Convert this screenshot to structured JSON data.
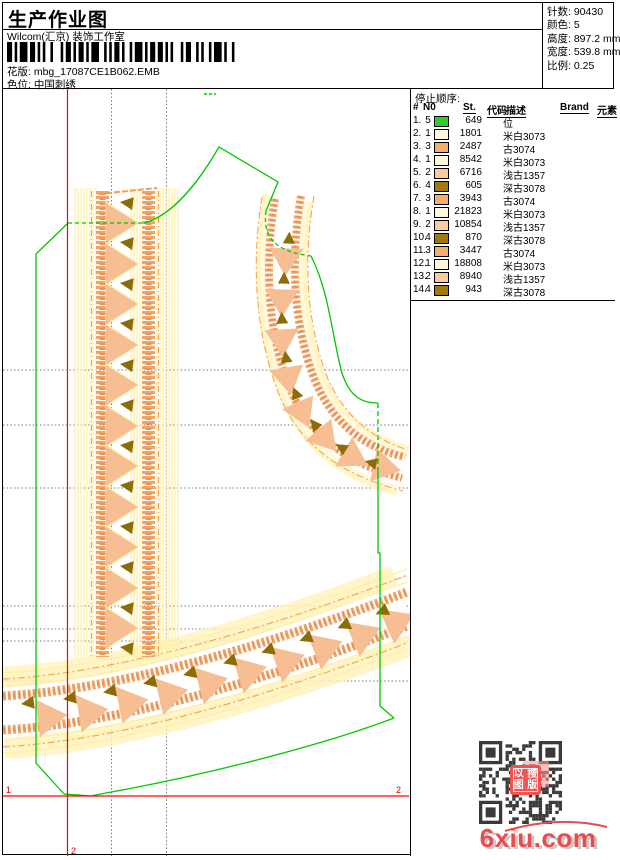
{
  "header": {
    "title": "生产作业图",
    "subtitle": "Wilcom(汇京) 装饰工作室",
    "pattern_label": "花版:",
    "pattern_value": "mbg_17087CE1B062.EMB",
    "colorway_label": "色位:",
    "colorway_value": "中国刺绣"
  },
  "info": {
    "stitches_label": "针数:",
    "stitches": "90430",
    "colors_label": "颜色:",
    "colors": "5",
    "height_label": "高度:",
    "height": "897.2 mm",
    "width_label": "宽度:",
    "width": "539.8 mm",
    "scale_label": "比例:",
    "scale": "0.25"
  },
  "stop_sequence": {
    "title": "停止顺序:",
    "columns": [
      "#",
      "N0",
      "St.",
      "代码",
      "描述",
      "Brand",
      "元素"
    ],
    "rows": [
      {
        "idx": "1.",
        "n0": "5",
        "st": "649",
        "code": "",
        "desc": "位",
        "color": "#2ecc2e"
      },
      {
        "idx": "2.",
        "n0": "1",
        "st": "1801",
        "code": "",
        "desc": "米白3073",
        "color": "#fff7db"
      },
      {
        "idx": "3.",
        "n0": "3",
        "st": "2487",
        "code": "",
        "desc": "古3074",
        "color": "#f5ad6e"
      },
      {
        "idx": "4.",
        "n0": "1",
        "st": "8542",
        "code": "",
        "desc": "米白3073",
        "color": "#fff7db"
      },
      {
        "idx": "5.",
        "n0": "2",
        "st": "6716",
        "code": "",
        "desc": "浅古1357",
        "color": "#f8cba1"
      },
      {
        "idx": "6.",
        "n0": "4",
        "st": "605",
        "code": "",
        "desc": "深古3078",
        "color": "#a1790e"
      },
      {
        "idx": "7.",
        "n0": "3",
        "st": "3943",
        "code": "",
        "desc": "古3074",
        "color": "#f5ad6e"
      },
      {
        "idx": "8.",
        "n0": "1",
        "st": "21823",
        "code": "",
        "desc": "米白3073",
        "color": "#fff7db"
      },
      {
        "idx": "9.",
        "n0": "2",
        "st": "10854",
        "code": "",
        "desc": "浅古1357",
        "color": "#f8cba1"
      },
      {
        "idx": "10.",
        "n0": "4",
        "st": "870",
        "code": "",
        "desc": "深古3078",
        "color": "#a1790e"
      },
      {
        "idx": "11.",
        "n0": "3",
        "st": "3447",
        "code": "",
        "desc": "古3074",
        "color": "#f5ad6e"
      },
      {
        "idx": "12.",
        "n0": "1",
        "st": "18808",
        "code": "",
        "desc": "米白3073",
        "color": "#fff7db"
      },
      {
        "idx": "13.",
        "n0": "2",
        "st": "8940",
        "code": "",
        "desc": "浅古1357",
        "color": "#f8cba1"
      },
      {
        "idx": "14.",
        "n0": "4",
        "st": "943",
        "code": "",
        "desc": "深古3078",
        "color": "#a1790e"
      }
    ]
  },
  "canvas_marks": {
    "start_label": "1",
    "end_label": "2",
    "origin_label": "2"
  },
  "watermark": {
    "site": "6xiu.com",
    "seal_chars": [
      "以",
      "搜",
      "图",
      "版"
    ]
  },
  "design_colors": {
    "outline_green": "#00c800",
    "hatch_yellow": "#ffefa4",
    "pale_fill": "#fff3bc",
    "chain_orange": "#f1a468",
    "chain_orange_dark": "#e8935a",
    "triangle_peach": "#f6be92",
    "triangle_dark": "#8c6c04",
    "guide_orange": "#f0a050",
    "grid_gray": "#7a7a7a",
    "axis_red": "#ff0000",
    "label_red": "#d40000"
  }
}
